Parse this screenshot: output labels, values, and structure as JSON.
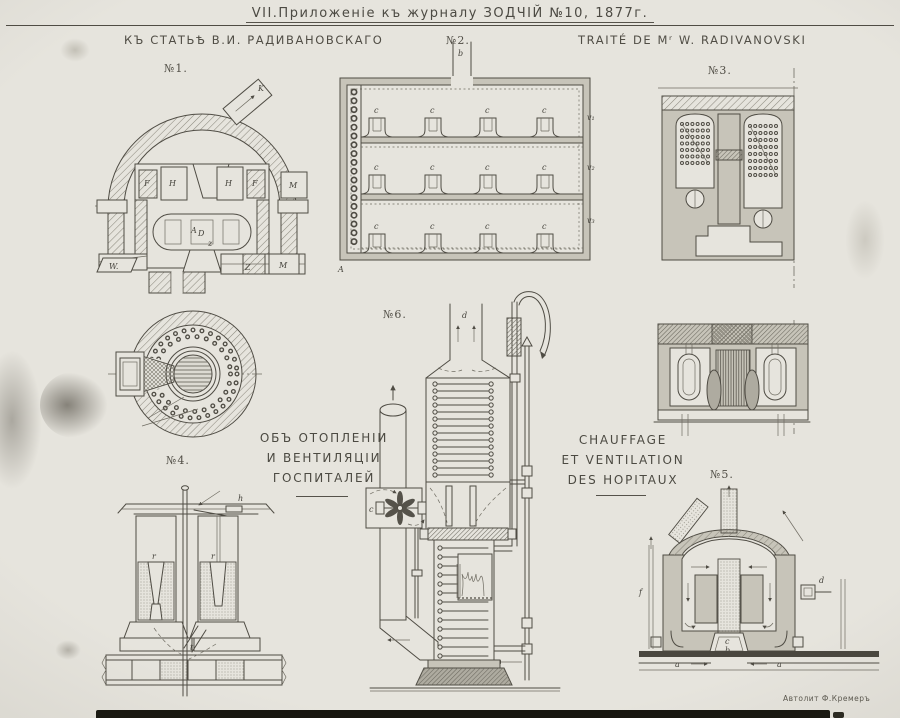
{
  "plate": {
    "title": "VII.Приложеніе къ журналу ЗОДЧІЙ №10, 1877г.",
    "header_left": "КЪ СТАТЬѢ В.И. РАДИВАНОВСКАГО",
    "header_right": "TRAITÉ DE Mʳ W. RADIVANOVSKI",
    "credit": "Автолит Ф.Кремеръ"
  },
  "captions": {
    "russian_line1": "ОБЪ ОТОПЛЕНІИ",
    "russian_line2": "И ВЕНТИЛЯЦІИ",
    "russian_line3": "ГОСПИТАЛЕЙ",
    "french_line1": "CHAUFFAGE",
    "french_line2": "ET VENTILATION",
    "french_line3": "DES HOPITAUX"
  },
  "figures": {
    "fig1": {
      "label": "№1.",
      "letters": {
        "k": "K",
        "h": "H",
        "f": "F",
        "m": "M",
        "d": "D",
        "a": "A",
        "w": "W.",
        "z": "Z",
        "zs": "z"
      }
    },
    "fig2": {
      "label": "№2.",
      "letters": {
        "b": "b",
        "c": "c",
        "a": "A",
        "v1": "v₁",
        "v2": "v₂",
        "v3": "v₃"
      }
    },
    "fig3": {
      "label": "№3."
    },
    "fig4": {
      "label": "№4.",
      "letters": {
        "h": "h",
        "r": "r",
        "k": "k",
        "t": "t"
      }
    },
    "fig5": {
      "label": "№5.",
      "letters": {
        "a": "a",
        "b": "b",
        "c": "c",
        "f": "f",
        "d": "d"
      }
    },
    "fig6": {
      "label": "№6.",
      "letters": {
        "c": "c",
        "d": "d"
      }
    }
  }
}
